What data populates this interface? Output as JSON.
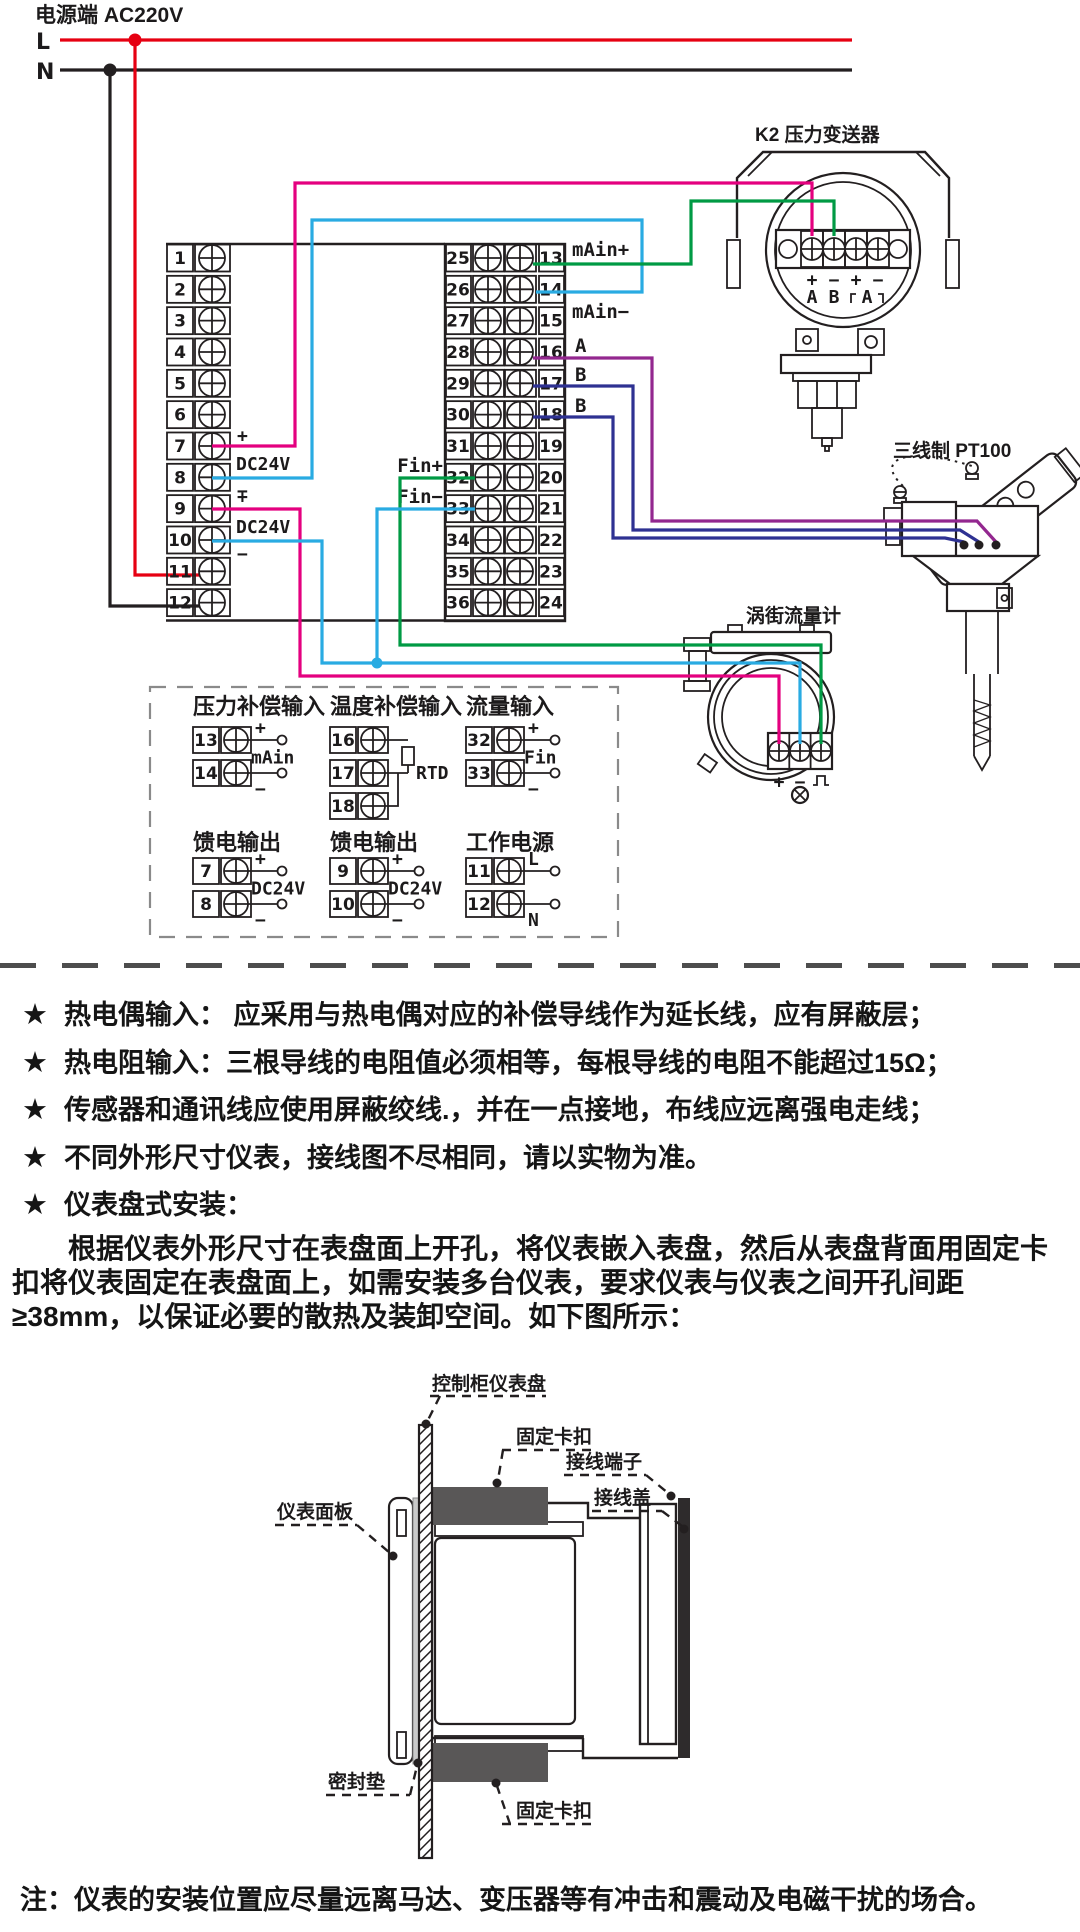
{
  "power": {
    "title": "电源端 AC220V",
    "l": "L",
    "n": "N"
  },
  "colors": {
    "live_red": "#e60012",
    "neutral_black": "#231f20",
    "pink": "#e4007f",
    "light_blue": "#29abe2",
    "green": "#009a44",
    "purple": "#93278f",
    "dark_blue": "#2e3192",
    "clip_gray": "#595757"
  },
  "instrument": {
    "left_terminals": [
      "1",
      "2",
      "3",
      "4",
      "5",
      "6",
      "7",
      "8",
      "9",
      "10",
      "11",
      "12"
    ],
    "mid_left_terminals": [
      "25",
      "26",
      "27",
      "28",
      "29",
      "30",
      "31",
      "32",
      "33",
      "34",
      "35",
      "36"
    ],
    "mid_right_terminals": [
      "13",
      "14",
      "15",
      "16",
      "17",
      "18",
      "19",
      "20",
      "21",
      "22",
      "23",
      "24"
    ],
    "left_labels": {
      "plus7": "+",
      "dc78": "DC24V",
      "minus8": "−",
      "plus9": "+",
      "dc910": "DC24V",
      "minus10": "−"
    },
    "mid_labels": {
      "main_plus": "mAin+",
      "main_minus": "mAin−",
      "a": "A",
      "b1": "B",
      "b2": "B",
      "fin_plus": "Fin+",
      "fin_minus": "Fin−"
    }
  },
  "devices": {
    "transmitter": {
      "label": "K2 压力变送器",
      "signs": [
        "+",
        "−",
        "+",
        "−"
      ],
      "names": [
        "A",
        "B",
        "A"
      ]
    },
    "pt100": {
      "label": "三线制 PT100"
    },
    "vortex": {
      "label": "涡街流量计",
      "plus": "+",
      "minus": "−"
    }
  },
  "detail_groups": [
    {
      "title": "压力补偿输入",
      "type": "two",
      "mid_label": "mAin",
      "rows": [
        {
          "num": "13",
          "sign": "+"
        },
        {
          "num": "14",
          "sign": "−"
        }
      ]
    },
    {
      "title": "温度补偿输入",
      "type": "rtd",
      "mid_label": "RTD",
      "rows": [
        {
          "num": "16"
        },
        {
          "num": "17"
        },
        {
          "num": "18"
        }
      ]
    },
    {
      "title": "流量输入",
      "type": "two",
      "mid_label": "Fin",
      "rows": [
        {
          "num": "32",
          "sign": "+"
        },
        {
          "num": "33",
          "sign": "−"
        }
      ]
    },
    {
      "title": "馈电输出",
      "type": "two",
      "mid_label": "DC24V",
      "rows": [
        {
          "num": "7",
          "sign": "+"
        },
        {
          "num": "8",
          "sign": "−"
        }
      ]
    },
    {
      "title": "馈电输出",
      "type": "two",
      "mid_label": "DC24V",
      "rows": [
        {
          "num": "9",
          "sign": "+"
        },
        {
          "num": "10",
          "sign": "−"
        }
      ]
    },
    {
      "title": "工作电源",
      "type": "two",
      "mid_label": "",
      "rows": [
        {
          "num": "11",
          "sign": "L"
        },
        {
          "num": "12",
          "sign": "N"
        }
      ]
    }
  ],
  "notes": {
    "bullet": "★",
    "items": [
      "热电偶输入： 应采用与热电偶对应的补偿导线作为延长线，应有屏蔽层；",
      "热电阻输入：三根导线的电阻值必须相等，每根导线的电阻不能超过15Ω；",
      "传感器和通讯线应使用屏蔽绞线.，并在一点接地，布线应远离强电走线；",
      "不同外形尺寸仪表，接线图不尽相同，请以实物为准。",
      "仪表盘式安装："
    ]
  },
  "paragraph": "根据仪表外形尺寸在表盘面上开孔，将仪表嵌入表盘，然后从表盘背面用固定卡扣将仪表固定在表盘面上，如需安装多台仪表，要求仪表与仪表之间开孔间距≥38mm，以保证必要的散热及装卸空间。如下图所示：",
  "install_labels": {
    "panel": "控制柜仪表盘",
    "clip_top": "固定卡扣",
    "terminals": "接线端子",
    "cover": "接线盖",
    "front": "仪表面板",
    "gasket": "密封垫",
    "clip_bottom": "固定卡扣"
  },
  "footer_note": "注：仪表的安装位置应尽量远离马达、变压器等有冲击和震动及电磁干扰的场合。"
}
